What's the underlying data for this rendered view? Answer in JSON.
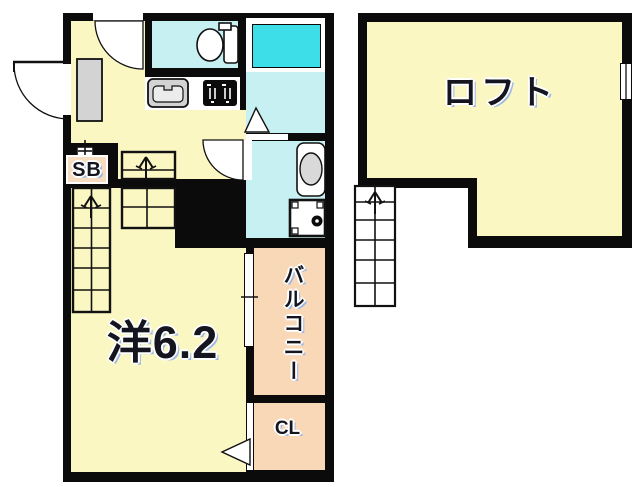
{
  "plan": {
    "unit_1f": {
      "main_room_label": "洋6.2",
      "balcony_label": "バルコニー",
      "closet_label": "CL",
      "shoe_box_label": "SB"
    },
    "loft": {
      "label": "ロフト"
    },
    "colors": {
      "wall": "#0b0b0b",
      "room_fill": "#faf7c3",
      "wet_fill": "#c7f0f2",
      "tub_fill": "#3edee9",
      "balcony_fill": "#f8d8b6",
      "fixture_gray": "#d3d3d3"
    }
  }
}
